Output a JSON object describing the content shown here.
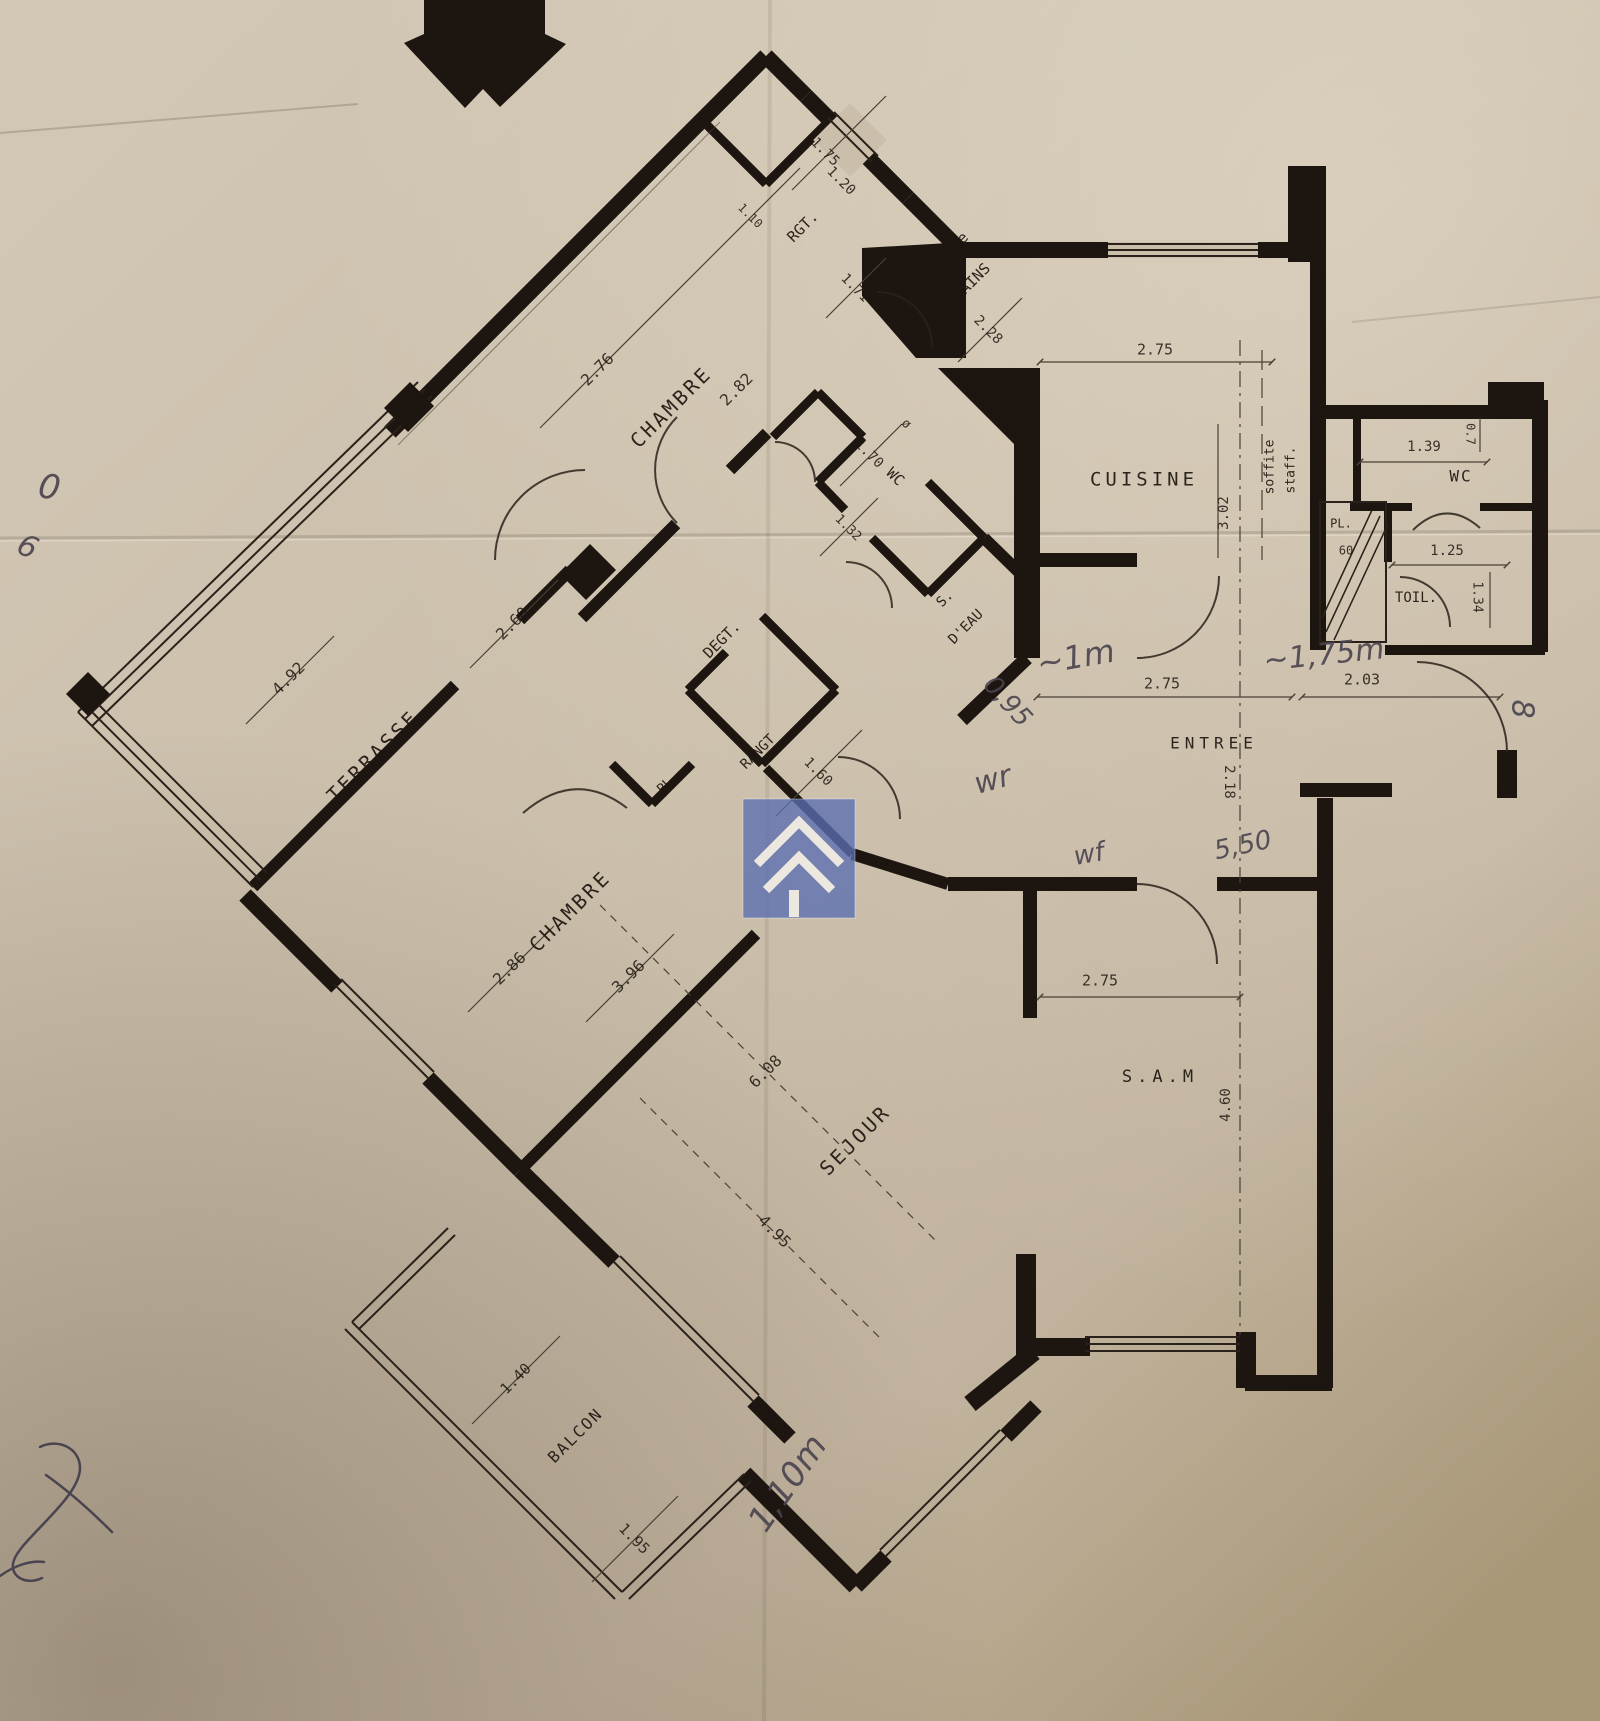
{
  "meta": {
    "document_type": "scanned apartment floor plan",
    "orientation_note": "left wing rotated 45 degrees, right wing orthogonal"
  },
  "colors": {
    "paper": "#cbbfab",
    "ink": "#1d1610",
    "pen": "#49434e",
    "wm": "#5a6eb1"
  },
  "watermark": {
    "shape": "translucent blue square with double white chevron",
    "color": "#5a6eb1"
  },
  "labels": [
    {
      "t": "CHAMBRE",
      "x": 672,
      "y": 408,
      "r": -45,
      "s": 20,
      "ls": 3,
      "k": "room"
    },
    {
      "t": "2.76",
      "x": 598,
      "y": 370,
      "r": -45,
      "s": 16,
      "k": "dim"
    },
    {
      "t": "2.82",
      "x": 737,
      "y": 390,
      "r": -45,
      "s": 16,
      "k": "dim"
    },
    {
      "t": "RGT.",
      "x": 803,
      "y": 227,
      "r": -45,
      "s": 15,
      "k": "room"
    },
    {
      "t": "1.75",
      "x": 825,
      "y": 152,
      "r": 45,
      "s": 14,
      "k": "dim"
    },
    {
      "t": "1.20",
      "x": 841,
      "y": 181,
      "r": 45,
      "s": 14,
      "k": "dim"
    },
    {
      "t": "1.71",
      "x": 855,
      "y": 288,
      "r": 45,
      "s": 14,
      "k": "dim"
    },
    {
      "t": "1.10",
      "x": 750,
      "y": 216,
      "r": 45,
      "s": 12,
      "k": "dim"
    },
    {
      "t": "S. de",
      "x": 950,
      "y": 251,
      "r": -45,
      "s": 15,
      "k": "room"
    },
    {
      "t": "BAINS",
      "x": 972,
      "y": 282,
      "r": -45,
      "s": 15,
      "k": "room"
    },
    {
      "t": "2.28",
      "x": 988,
      "y": 330,
      "r": 45,
      "s": 14,
      "k": "dim"
    },
    {
      "t": "WC",
      "x": 895,
      "y": 477,
      "r": 45,
      "s": 15,
      "k": "room"
    },
    {
      "t": "1.70",
      "x": 869,
      "y": 454,
      "r": 45,
      "s": 14,
      "k": "dim"
    },
    {
      "t": "ø",
      "x": 906,
      "y": 424,
      "r": 45,
      "s": 13,
      "k": "dim"
    },
    {
      "t": "S.",
      "x": 945,
      "y": 599,
      "r": -45,
      "s": 14,
      "k": "room"
    },
    {
      "t": "D'EAU",
      "x": 966,
      "y": 627,
      "r": -45,
      "s": 14,
      "k": "room"
    },
    {
      "t": "1.32",
      "x": 848,
      "y": 528,
      "r": 45,
      "s": 13,
      "k": "dim"
    },
    {
      "t": "DEGT.",
      "x": 722,
      "y": 640,
      "r": -45,
      "s": 15,
      "k": "room"
    },
    {
      "t": "PL",
      "x": 665,
      "y": 786,
      "r": -45,
      "s": 13,
      "k": "room"
    },
    {
      "t": "RANGT",
      "x": 758,
      "y": 752,
      "r": -45,
      "s": 14,
      "k": "room"
    },
    {
      "t": "1.60",
      "x": 818,
      "y": 772,
      "r": 45,
      "s": 14,
      "k": "dim"
    },
    {
      "t": "TERRASSE",
      "x": 374,
      "y": 757,
      "r": -45,
      "s": 20,
      "ls": 3,
      "k": "room"
    },
    {
      "t": "2.60",
      "x": 513,
      "y": 624,
      "r": -45,
      "s": 16,
      "k": "dim"
    },
    {
      "t": "4.92",
      "x": 289,
      "y": 679,
      "r": -45,
      "s": 16,
      "k": "dim"
    },
    {
      "t": "CHAMBRE",
      "x": 571,
      "y": 912,
      "r": -45,
      "s": 20,
      "ls": 3,
      "k": "room"
    },
    {
      "t": "2.86",
      "x": 510,
      "y": 969,
      "r": -45,
      "s": 16,
      "k": "dim"
    },
    {
      "t": "3.96",
      "x": 629,
      "y": 977,
      "r": -45,
      "s": 16,
      "k": "dim"
    },
    {
      "t": "SEJOUR",
      "x": 856,
      "y": 1141,
      "r": -45,
      "s": 20,
      "ls": 3,
      "k": "room"
    },
    {
      "t": "6.08",
      "x": 766,
      "y": 1072,
      "r": -45,
      "s": 16,
      "k": "dim"
    },
    {
      "t": "4.95",
      "x": 774,
      "y": 1232,
      "r": 45,
      "s": 16,
      "k": "dim"
    },
    {
      "t": "BALCON",
      "x": 576,
      "y": 1436,
      "r": -45,
      "s": 16,
      "ls": 2,
      "k": "room"
    },
    {
      "t": "1.40",
      "x": 516,
      "y": 1379,
      "r": -45,
      "s": 15,
      "k": "dim"
    },
    {
      "t": "1.95",
      "x": 634,
      "y": 1539,
      "r": 45,
      "s": 15,
      "k": "dim"
    },
    {
      "t": "CUISINE",
      "x": 1144,
      "y": 480,
      "r": 0,
      "s": 19,
      "ls": 4,
      "k": "room"
    },
    {
      "t": "2.75",
      "x": 1155,
      "y": 350,
      "r": 0,
      "s": 15,
      "k": "dim"
    },
    {
      "t": "3.02",
      "x": 1224,
      "y": 513,
      "r": -90,
      "s": 14,
      "k": "dim"
    },
    {
      "t": "soffite",
      "x": 1270,
      "y": 467,
      "r": -90,
      "s": 13,
      "k": "room"
    },
    {
      "t": "staff.",
      "x": 1291,
      "y": 470,
      "r": -90,
      "s": 13,
      "k": "room"
    },
    {
      "t": "WC",
      "x": 1461,
      "y": 477,
      "r": 0,
      "s": 16,
      "ls": 2,
      "k": "room"
    },
    {
      "t": "1.39",
      "x": 1424,
      "y": 447,
      "r": 0,
      "s": 14,
      "k": "dim"
    },
    {
      "t": "0.7",
      "x": 1470,
      "y": 434,
      "r": 90,
      "s": 12,
      "k": "dim"
    },
    {
      "t": "PL.",
      "x": 1341,
      "y": 524,
      "r": 0,
      "s": 12,
      "k": "room"
    },
    {
      "t": "60",
      "x": 1346,
      "y": 551,
      "r": 0,
      "s": 12,
      "k": "dim"
    },
    {
      "t": "1.25",
      "x": 1447,
      "y": 551,
      "r": 0,
      "s": 14,
      "k": "dim"
    },
    {
      "t": "TOIL.",
      "x": 1416,
      "y": 598,
      "r": 0,
      "s": 14,
      "k": "room"
    },
    {
      "t": "1.34",
      "x": 1477,
      "y": 597,
      "r": 90,
      "s": 13,
      "k": "dim"
    },
    {
      "t": "ENTREE",
      "x": 1214,
      "y": 744,
      "r": 0,
      "s": 16,
      "ls": 5,
      "k": "room"
    },
    {
      "t": "2.75",
      "x": 1162,
      "y": 684,
      "r": 0,
      "s": 15,
      "k": "dim"
    },
    {
      "t": "2.18",
      "x": 1229,
      "y": 782,
      "r": 90,
      "s": 14,
      "k": "dim"
    },
    {
      "t": "2.03",
      "x": 1362,
      "y": 680,
      "r": 0,
      "s": 15,
      "k": "dim"
    },
    {
      "t": "S.A.M",
      "x": 1160,
      "y": 1077,
      "r": 0,
      "s": 17,
      "ls": 5,
      "k": "room"
    },
    {
      "t": "2.75",
      "x": 1100,
      "y": 981,
      "r": 0,
      "s": 15,
      "k": "dim"
    },
    {
      "t": "4.60",
      "x": 1226,
      "y": 1105,
      "r": -90,
      "s": 14,
      "k": "dim"
    },
    {
      "t": "~1,75m",
      "x": 1324,
      "y": 656,
      "r": -6,
      "s": 30,
      "k": "hand"
    },
    {
      "t": "~1m",
      "x": 1076,
      "y": 659,
      "r": -10,
      "s": 32,
      "k": "hand"
    },
    {
      "t": "0,95",
      "x": 1007,
      "y": 702,
      "r": 48,
      "s": 26,
      "k": "hand"
    },
    {
      "t": "wr",
      "x": 993,
      "y": 781,
      "r": -15,
      "s": 30,
      "k": "hand"
    },
    {
      "t": "wf",
      "x": 1089,
      "y": 855,
      "r": -10,
      "s": 26,
      "k": "hand"
    },
    {
      "t": "5,50",
      "x": 1243,
      "y": 846,
      "r": -12,
      "s": 26,
      "k": "hand"
    },
    {
      "t": "8",
      "x": 1521,
      "y": 709,
      "r": 90,
      "s": 30,
      "k": "hand"
    },
    {
      "t": "1,10m",
      "x": 789,
      "y": 1484,
      "r": -55,
      "s": 34,
      "k": "hand"
    },
    {
      "t": "0",
      "x": 49,
      "y": 489,
      "r": 10,
      "s": 34,
      "k": "hand"
    },
    {
      "t": "6",
      "x": 27,
      "y": 548,
      "r": 25,
      "s": 30,
      "k": "hand"
    }
  ]
}
